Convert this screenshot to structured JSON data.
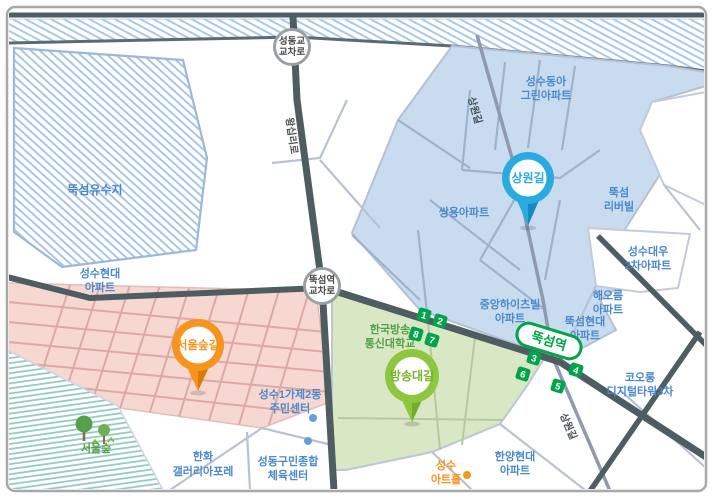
{
  "colors": {
    "label-blue": "#4a89cc",
    "label-green": "#53a147",
    "label-orange": "#f7941d",
    "roadname": "#4a5358",
    "subway-green": "#00a44a",
    "pin-blue": "#29abe2",
    "pin-orange": "#f7941d",
    "pin-green": "#8dc63f",
    "pin-green-text": "#74b32a",
    "region-blue": "#c9dcef",
    "region-pink": "#f7d7d2",
    "region-green": "#d9e7c5",
    "road-dark": "#4d5d62",
    "road-light": "#b9c1d4"
  },
  "pins": [
    {
      "label": "상원길"
    },
    {
      "label": "서울숲길"
    },
    {
      "label": "방송대길"
    }
  ],
  "intersections": [
    {
      "line1": "성동교",
      "line2": "교차로"
    },
    {
      "line1": "뚝섬역",
      "line2": "교차로"
    }
  ],
  "station": {
    "name": "뚝섬역",
    "exits": [
      "1",
      "2",
      "8",
      "7",
      "3",
      "6",
      "4",
      "5"
    ]
  },
  "roads": [
    {
      "name": "왕십리로"
    },
    {
      "name": "상원길"
    },
    {
      "name": "상원길"
    }
  ],
  "places": [
    {
      "line1": "뚝섬유수지",
      "line2": ""
    },
    {
      "line1": "성수현대",
      "line2": "아파트"
    },
    {
      "line1": "성수동아",
      "line2": "그린아파트"
    },
    {
      "line1": "쌍용아파트",
      "line2": ""
    },
    {
      "line1": "뚝섬",
      "line2": "리버빌"
    },
    {
      "line1": "성수대우",
      "line2": "2차아파트"
    },
    {
      "line1": "해오름",
      "line2": "아파트"
    },
    {
      "line1": "뚝섬현대",
      "line2": "아파트"
    },
    {
      "line1": "중앙하이츠빌",
      "line2": "아파트"
    },
    {
      "line1": "코오롱",
      "line2": "디지털타워3차"
    },
    {
      "line1": "한국방송",
      "line2": "통신대학교"
    },
    {
      "line1": "성수1가제2동",
      "line2": "주민센터"
    },
    {
      "line1": "성동구민종합",
      "line2": "체육센터"
    },
    {
      "line1": "한화",
      "line2": "갤러리아포레"
    },
    {
      "line1": "서울숲",
      "line2": ""
    },
    {
      "line1": "성수",
      "line2": "아트홀"
    },
    {
      "line1": "한양현대",
      "line2": "아파트"
    }
  ]
}
